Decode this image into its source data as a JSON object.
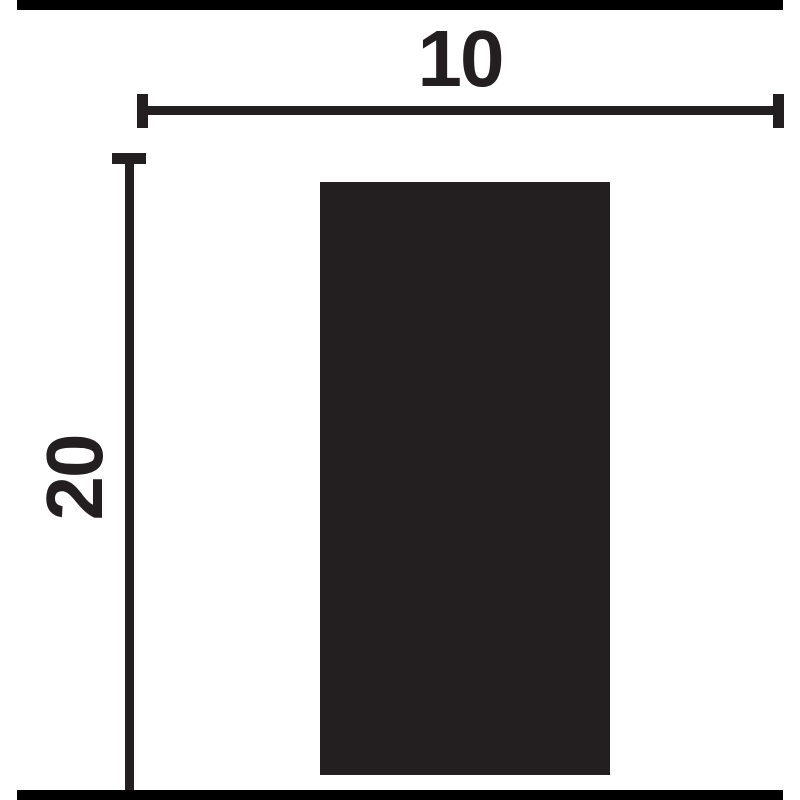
{
  "diagram": {
    "type": "dimension-drawing",
    "background_color": "#ffffff",
    "ink_color": "#231f20",
    "border_bar_color": "#000000",
    "width_dimension": {
      "label": "10",
      "value": 10,
      "orientation": "horizontal"
    },
    "height_dimension": {
      "label": "20",
      "value": 20,
      "orientation": "vertical"
    },
    "shape": "solid rectangle cross-section, aspect 10 wide by 20 tall"
  }
}
